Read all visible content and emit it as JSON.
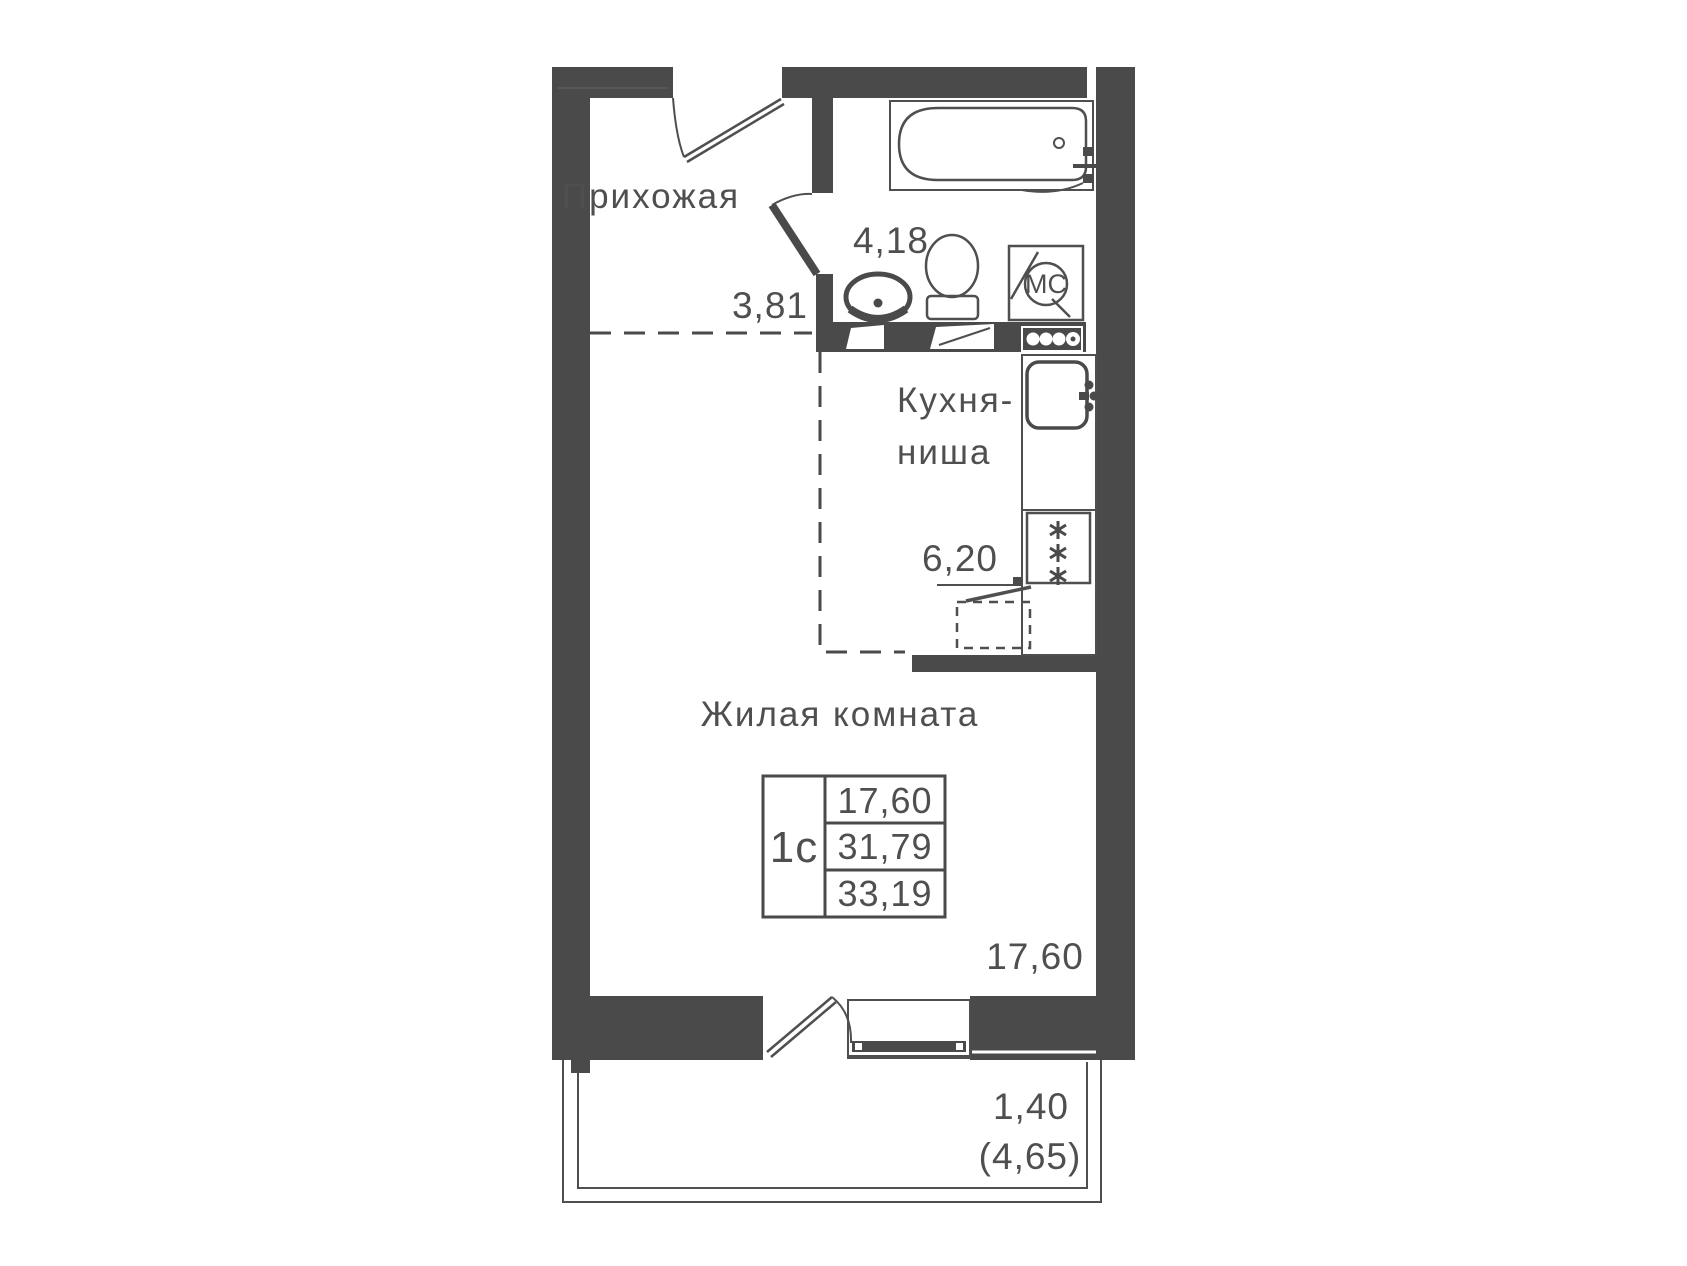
{
  "unit": {
    "type_label": "1с",
    "areas": {
      "row1": "17,60",
      "row2": "31,79",
      "row3": "33,19"
    }
  },
  "rooms": {
    "hallway": {
      "name": "Прихожая",
      "area": "3,81"
    },
    "bathroom": {
      "area": "4,18"
    },
    "kitchen": {
      "name_line1": "Кухня-",
      "name_line2": "ниша",
      "area": "6,20"
    },
    "living": {
      "name": "Жилая комната",
      "area": "17,60"
    },
    "balcony": {
      "width": "1,40",
      "area_paren": "(4,65)"
    }
  },
  "fixtures": {
    "washing_machine_label": "МС"
  },
  "icons": {
    "stove-burner-icon": "six-point-asterisk",
    "washing-machine-icon": "circle-with-МС",
    "door-icon": "leaf-with-swing-arc"
  },
  "colors": {
    "wall": "#4a4a4a",
    "line": "#4f4f4f",
    "text": "#4f4f4f",
    "background": "#ffffff"
  }
}
